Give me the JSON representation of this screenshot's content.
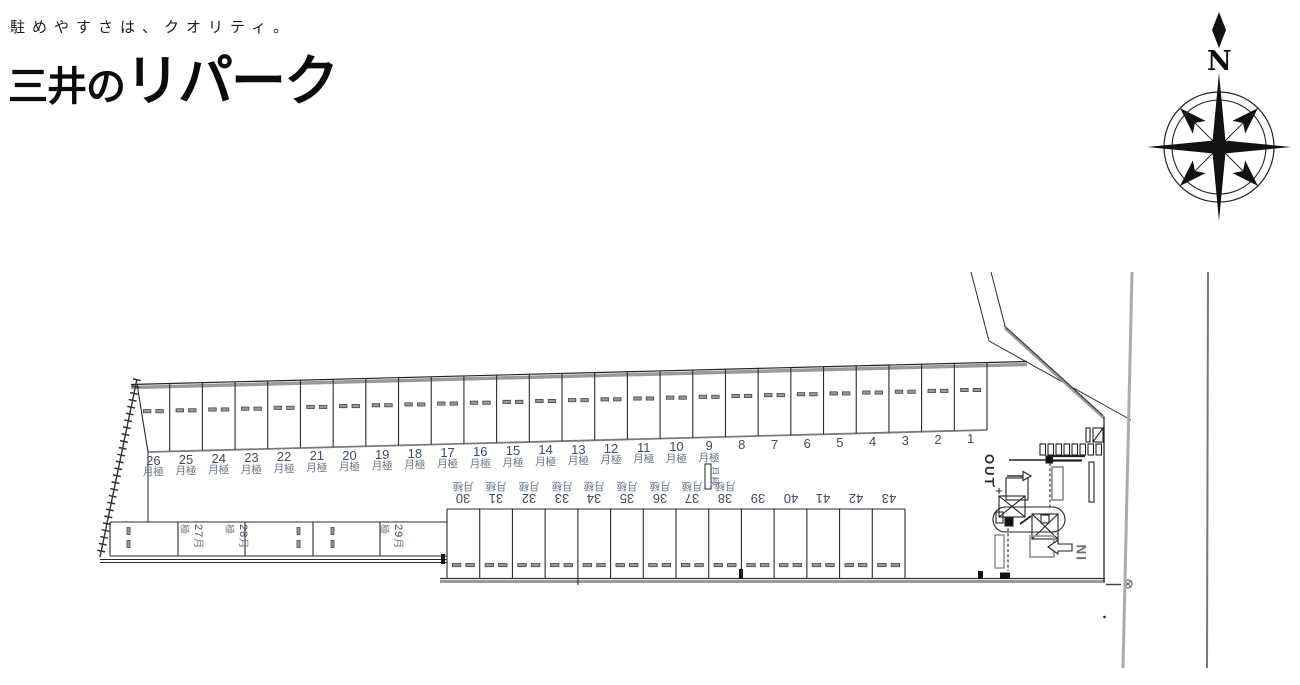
{
  "branding": {
    "tagline": "駐めやすさは、クオリティ。",
    "logo_prefix": "三井の",
    "logo_main": "リパーク"
  },
  "compass": {
    "north_label": "N"
  },
  "labels": {
    "monthly": "月極",
    "in": "IN",
    "out": "OUT"
  },
  "colors": {
    "number_text": "#3d4c63",
    "line": "#2a2a2a",
    "thick_line": "#999999"
  },
  "site_plan": {
    "top_row": {
      "spaces": [
        {
          "number": "26",
          "monthly": true
        },
        {
          "number": "25",
          "monthly": true
        },
        {
          "number": "24",
          "monthly": true
        },
        {
          "number": "23",
          "monthly": true
        },
        {
          "number": "22",
          "monthly": true
        },
        {
          "number": "21",
          "monthly": true
        },
        {
          "number": "20",
          "monthly": true
        },
        {
          "number": "19",
          "monthly": true
        },
        {
          "number": "18",
          "monthly": true
        },
        {
          "number": "17",
          "monthly": true
        },
        {
          "number": "16",
          "monthly": true
        },
        {
          "number": "15",
          "monthly": true
        },
        {
          "number": "14",
          "monthly": true
        },
        {
          "number": "13",
          "monthly": true
        },
        {
          "number": "12",
          "monthly": true
        },
        {
          "number": "11",
          "monthly": true
        },
        {
          "number": "10",
          "monthly": true
        },
        {
          "number": "9",
          "monthly": true
        },
        {
          "number": "8",
          "monthly": false
        },
        {
          "number": "7",
          "monthly": false
        },
        {
          "number": "6",
          "monthly": false
        },
        {
          "number": "5",
          "monthly": false
        },
        {
          "number": "4",
          "monthly": false
        },
        {
          "number": "3",
          "monthly": false
        },
        {
          "number": "2",
          "monthly": false
        },
        {
          "number": "1",
          "monthly": false
        }
      ]
    },
    "side_row": {
      "spaces": [
        {
          "number": "27",
          "monthly": true
        },
        {
          "number": "28",
          "monthly": true
        },
        {
          "number": "29",
          "monthly": true
        }
      ]
    },
    "bottom_row": {
      "spaces": [
        {
          "number": "30",
          "monthly": true
        },
        {
          "number": "31",
          "monthly": true
        },
        {
          "number": "32",
          "monthly": true
        },
        {
          "number": "33",
          "monthly": true
        },
        {
          "number": "34",
          "monthly": true
        },
        {
          "number": "35",
          "monthly": true
        },
        {
          "number": "36",
          "monthly": true
        },
        {
          "number": "37",
          "monthly": true
        },
        {
          "number": "38",
          "monthly": true
        },
        {
          "number": "39",
          "monthly": false
        },
        {
          "number": "40",
          "monthly": false
        },
        {
          "number": "41",
          "monthly": false
        },
        {
          "number": "42",
          "monthly": false
        },
        {
          "number": "43",
          "monthly": false
        }
      ]
    },
    "pole_sign": {
      "text": "月極"
    }
  }
}
